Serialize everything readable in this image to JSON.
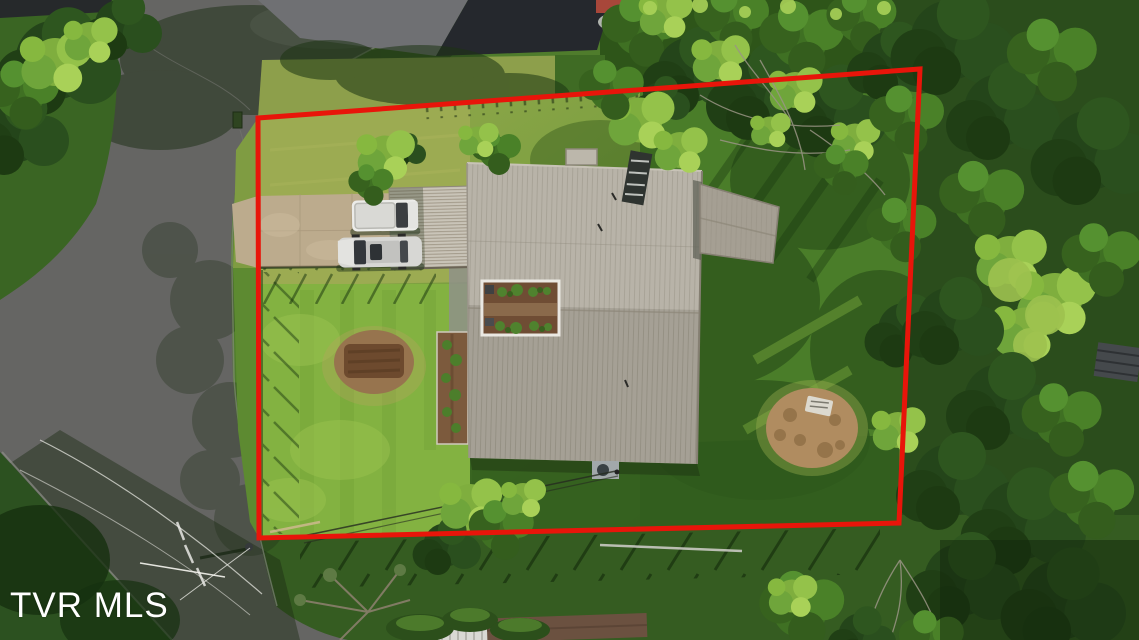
{
  "watermark": {
    "label": "TVR MLS"
  },
  "scene": {
    "boundary_color": "#e8150a",
    "roof_color": "#b2ada1",
    "wing_roof_color": "#a59f93",
    "carport_color": "#c9c4b8",
    "road_color": "#656563",
    "driveway_color": "#bcab8d",
    "lawn_sunlit_color": "#9cab52",
    "lawn_bright_color": "#83b241",
    "lawn_shaded_color": "#2f5a1d",
    "forest_color": "#2b4d1c",
    "vehicles": [
      "pickup-truck",
      "suv"
    ]
  }
}
